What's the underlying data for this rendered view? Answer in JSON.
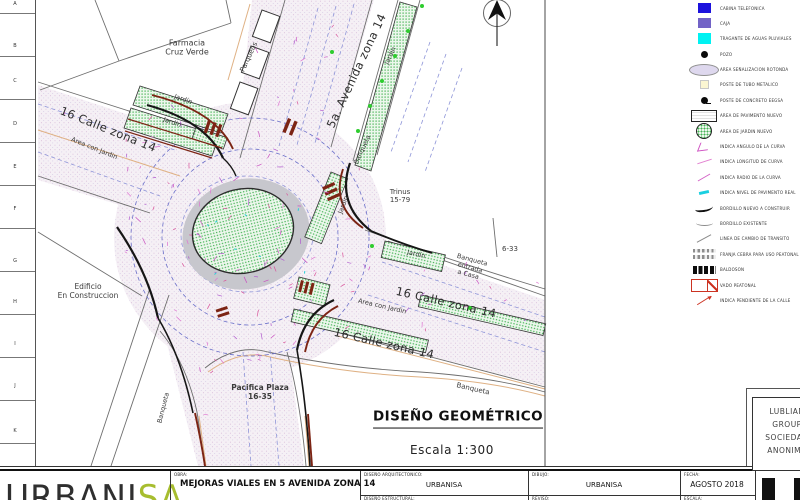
{
  "sheet": {
    "grid_rows": [
      "A",
      "B",
      "C",
      "D",
      "E",
      "F",
      "G",
      "H",
      "I",
      "J",
      "K"
    ]
  },
  "plan": {
    "title": "DISEÑO GEOMÉTRICO",
    "scale": "Escala  1:300",
    "labels": {
      "farmacia": "Farmacia\nCruz Verde",
      "parqueos": "Parqueos",
      "avenida": "5a. Avenida zona 14",
      "jardin": "Jardín",
      "banqueta": "Banqueta",
      "calle16": "16 Calle zona 14",
      "area_con_jardin": "Area con Jardin",
      "edificio": "Edificio\nEn Construccion",
      "trinus": "Trinus\n15-79",
      "lote_6_33": "6-33",
      "banqueta_entrada": "Banqueta\nentrada\na Casa",
      "pacifica": "Pacifica Plaza\n16-35"
    }
  },
  "legend": {
    "items": [
      {
        "swatch": "cabina",
        "label": "CABINA TELEFONICA"
      },
      {
        "swatch": "caja",
        "label": "CAJA"
      },
      {
        "swatch": "tragante",
        "label": "TRAGANTE DE AGUAS PLUVIALES"
      },
      {
        "swatch": "pozo",
        "label": "POZO"
      },
      {
        "swatch": "rotonda",
        "label": "AREA SEÑALIZACION ROTONDA"
      },
      {
        "swatch": "poste-metal",
        "label": "POSTE DE TUBO METALICO"
      },
      {
        "swatch": "poste-concreto",
        "label": "POSTE DE CONCRETO EEGSA"
      },
      {
        "swatch": "pavimento",
        "label": "AREA DE PAVIMENTO NUEVO"
      },
      {
        "swatch": "jardin-nuevo",
        "label": "AREA DE JARDIN NUEVO"
      },
      {
        "swatch": "angulo",
        "label": "INDICA ANGULO DE LA CURVA"
      },
      {
        "swatch": "longitud",
        "label": "INDICA LONGITUD DE CURVA"
      },
      {
        "swatch": "radio",
        "label": "INDICA RADIO DE LA CURVA"
      },
      {
        "swatch": "nivel",
        "label": "INDICA NIVEL DE PAVIMENTO REAL"
      },
      {
        "swatch": "bordillo-nuevo",
        "label": "BORDILLO NUEVO A CONSTRUIR"
      },
      {
        "swatch": "bordillo-exist",
        "label": "BORDILLO EXISTENTE"
      },
      {
        "swatch": "linea-cambio",
        "label": "LINEA DE CAMBIO DE TRANSITO"
      },
      {
        "swatch": "cebra",
        "label": "FRANJA CEBRA PARA USO PEATONAL"
      },
      {
        "swatch": "baldoson",
        "label": "BALDOSON"
      },
      {
        "swatch": "vado",
        "label": "VADO PEATONAL"
      },
      {
        "swatch": "pendiente",
        "label": "INDICA PENDIENTE DE LA CALLE"
      }
    ]
  },
  "titleblock": {
    "obra_label": "OBRA:",
    "obra": "MEJORAS VIALES EN 5 AVENIDA ZONA 14",
    "fields": [
      {
        "label": "DISEÑO ARQUITECTONICO:",
        "value": "URBANISA"
      },
      {
        "label": "DIBUJO:",
        "value": "URBANISA"
      },
      {
        "label": "FECHA:",
        "value": "AGOSTO 2018"
      },
      {
        "label": "DISEÑO ESTRUCTURAL:",
        "value": ""
      },
      {
        "label": "REVISO:",
        "value": ""
      },
      {
        "label": "ESCALA:",
        "value": ""
      }
    ],
    "logo": {
      "part1": "URBANI",
      "part2": "SA"
    },
    "stamp_lines": [
      "LUBLIAN",
      "GROUP",
      "SOCIEDAD",
      "ANONIMA"
    ]
  },
  "colors": {
    "logo_green": "#a7bd2f",
    "legend_blue": "#1c12dd",
    "legend_purple": "#7263c6",
    "legend_cyan": "#00f2f2",
    "garden_green": "#46b356",
    "pavement_tint": "#e9dff0",
    "annotation_magenta": "#c94fc0",
    "curb_red": "#7c2414"
  }
}
